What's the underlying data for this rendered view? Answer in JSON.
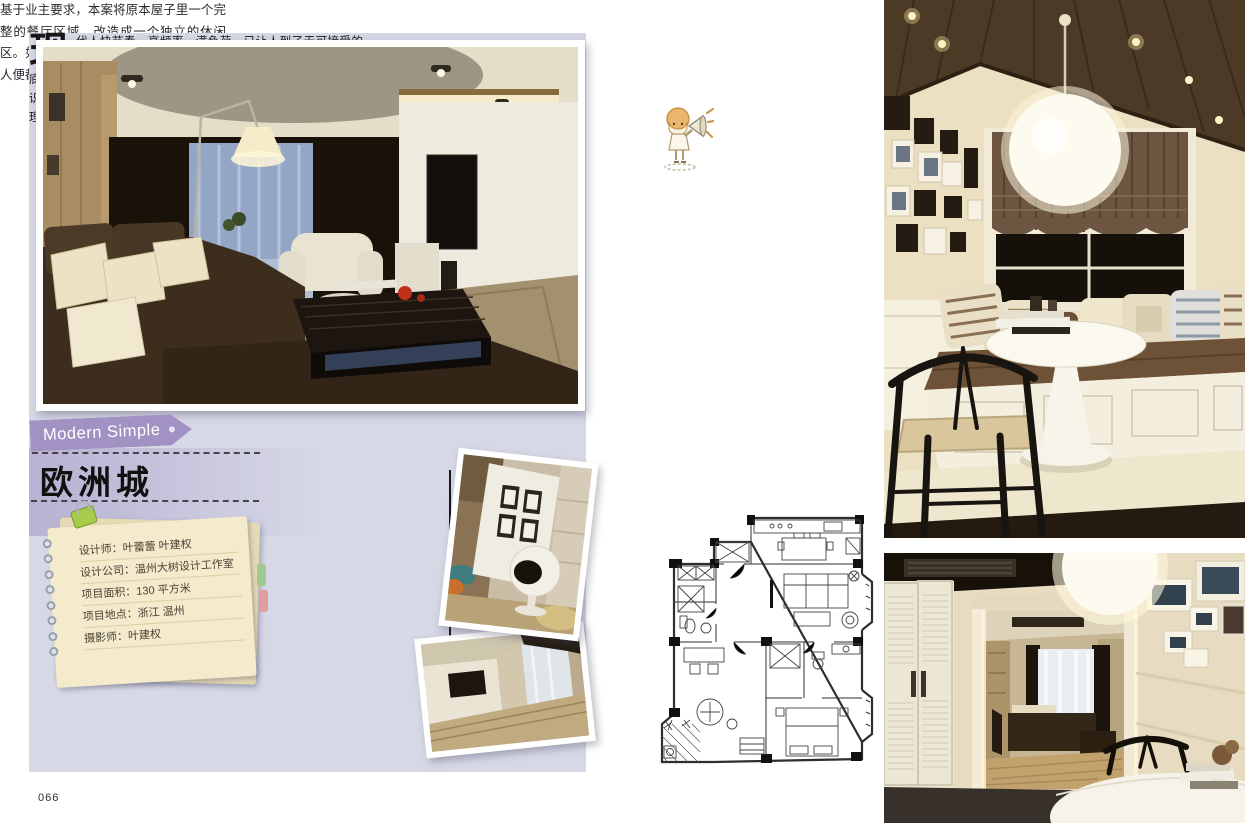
{
  "page": {
    "number": "066"
  },
  "tag": {
    "label": "Modern Simple"
  },
  "title": {
    "text": "欧洲城"
  },
  "notepad": {
    "lines": [
      "设计师：叶蕾蕾 叶建权",
      "设计公司：温州大树设计工作室",
      "项目面积：130 平方米",
      "项目地点：浙江 温州",
      "摄影师：叶建权"
    ]
  },
  "intro": {
    "dropcap": "现",
    "text": "代人快节奏、高频率、满负荷，已让人到了无可接受的地步。人们在这日趋繁忙的生活中，渴望得到一种能彻底放松、以简洁和纯净来调节转换精神的空间，这是人们在互补意识的支配下，所产生的亟欲摆脱烦琐、复杂、追求简单和自然的心理。"
  },
  "note": {
    "text": "基于业主要求，本案将原本屋子里一个完整的餐厅区域，改造成一个独立的休闲区。如此一来，加上原有的书房，男女主人便都拥有了个属于个人的休闲空间。"
  },
  "colors": {
    "panel_lavender": "#d6d8e6",
    "accent_purple": "#a292c4",
    "notepad_cream": "#f4eacc",
    "tag_text": "#ffffff"
  },
  "icons": {
    "announcer": "megaphone-girl-icon"
  }
}
